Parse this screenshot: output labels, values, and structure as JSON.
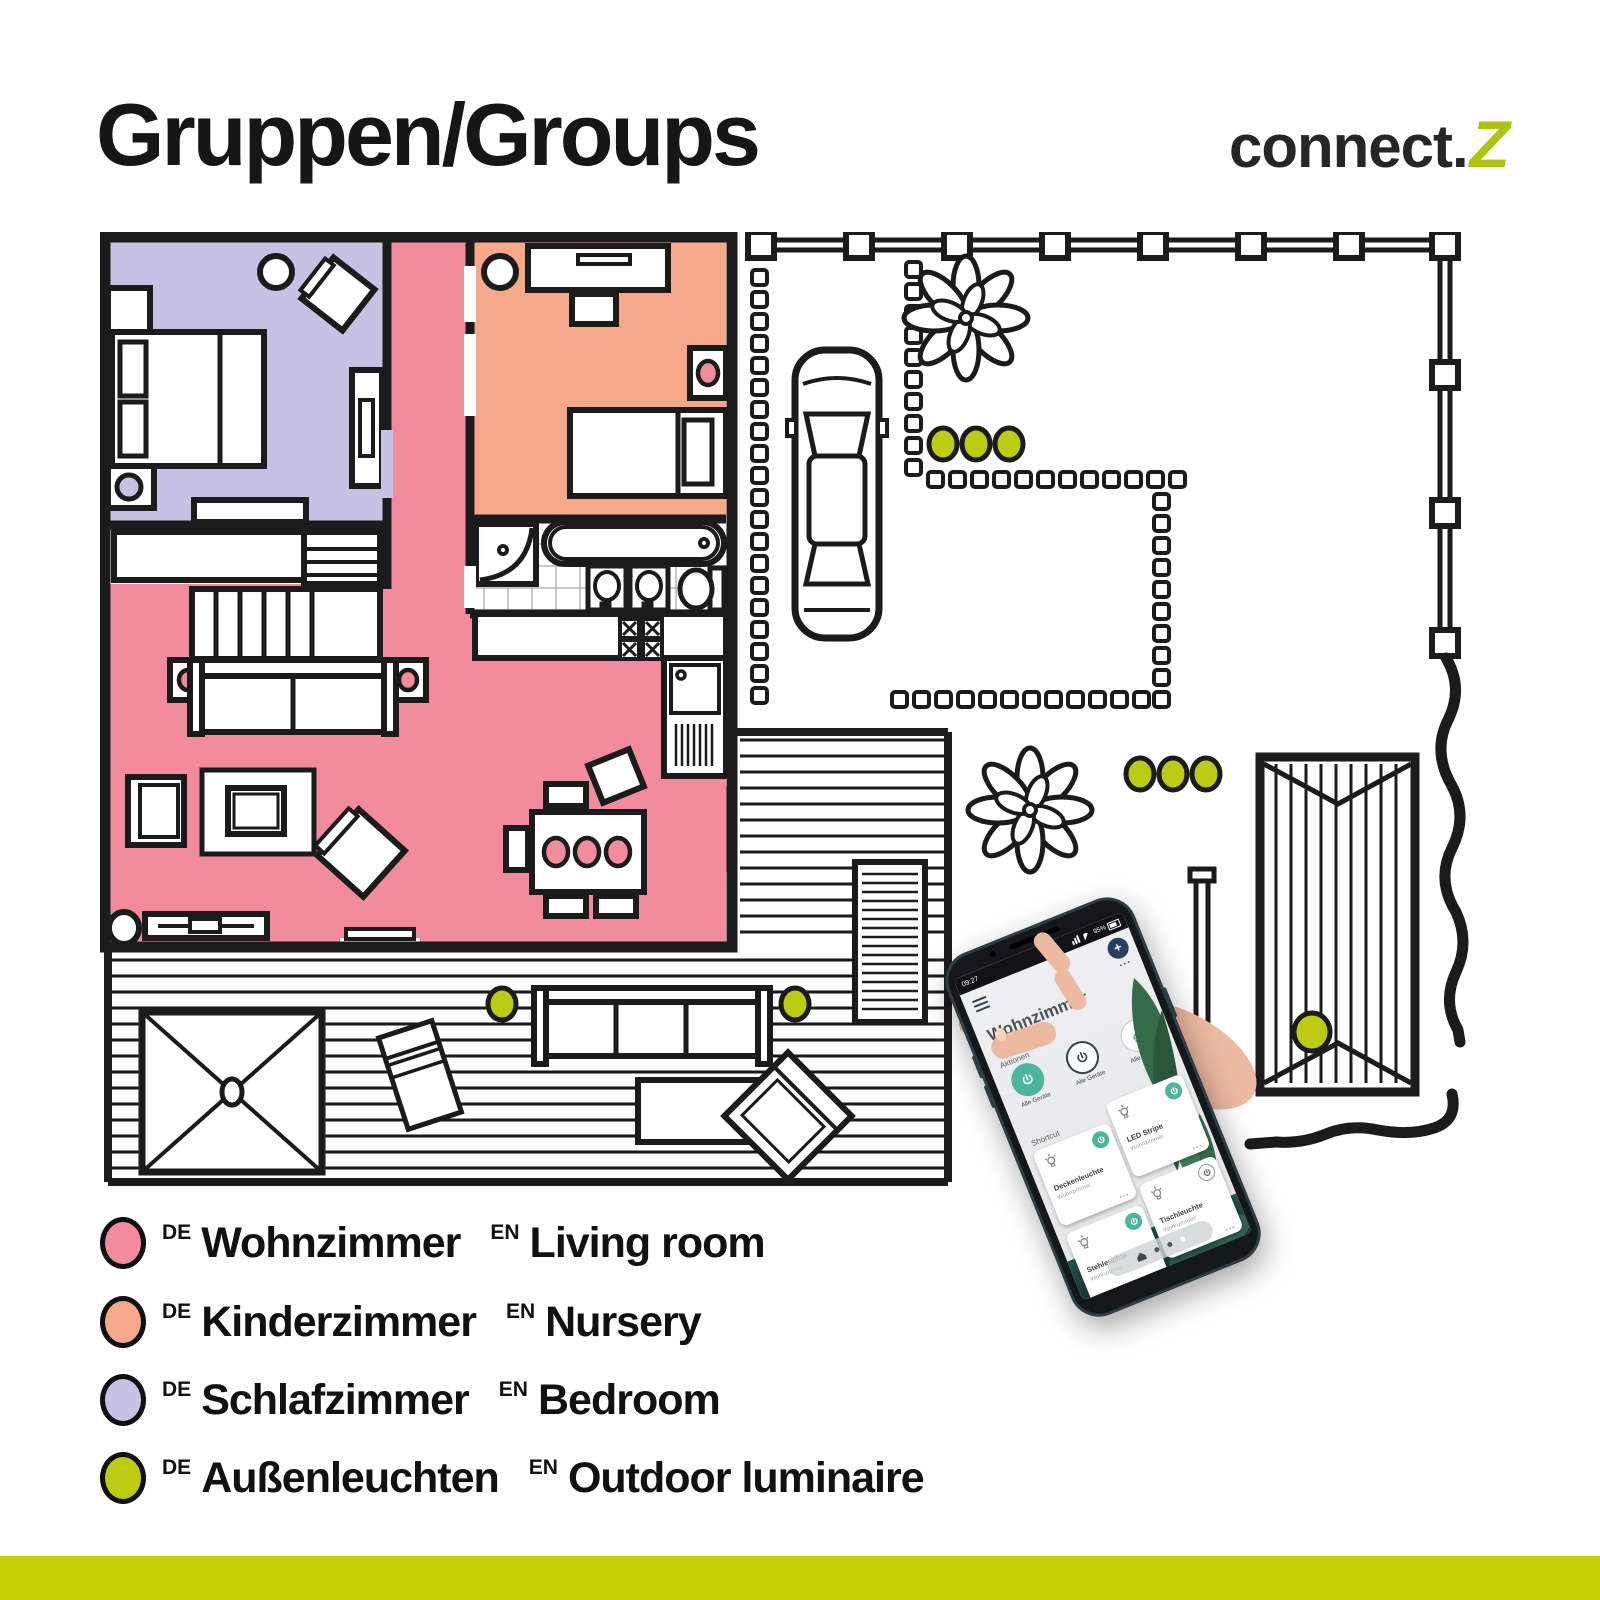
{
  "header": {
    "title": "Gruppen/Groups"
  },
  "brand": {
    "name": "connect.",
    "z": "Z"
  },
  "colors": {
    "living_room": "#F28C9D",
    "nursery": "#F5A98A",
    "bedroom": "#C7C1E4",
    "outdoor": "#BCCC12",
    "bottom_bar": "#C3CF02",
    "brand_z": "#AFC20F",
    "app_accent": "#4CB59C"
  },
  "legend": {
    "items": [
      {
        "de_tag": "DE",
        "de": "Wohnzimmer",
        "en_tag": "EN",
        "en": "Living room",
        "color": "#F28C9D"
      },
      {
        "de_tag": "DE",
        "de": "Kinderzimmer",
        "en_tag": "EN",
        "en": "Nursery",
        "color": "#F5A98A"
      },
      {
        "de_tag": "DE",
        "de": "Schlafzimmer",
        "en_tag": "EN",
        "en": "Bedroom",
        "color": "#C7C1E4"
      },
      {
        "de_tag": "DE",
        "de": "Außenleuchten",
        "en_tag": "EN",
        "en": "Outdoor luminaire",
        "color": "#BCCC12"
      }
    ]
  },
  "floor_plan": {
    "rooms": [
      {
        "name": "Wohnzimmer",
        "color": "#F28C9D"
      },
      {
        "name": "Kinderzimmer",
        "color": "#F5A98A"
      },
      {
        "name": "Schlafzimmer",
        "color": "#C7C1E4"
      }
    ],
    "outdoor_light_count": 9
  },
  "phone": {
    "status_bar": {
      "time": "09:27",
      "battery": "95%"
    },
    "app": {
      "title": "Wohnzimmer",
      "add_icon": "+",
      "more_icon": "...",
      "actions_label": "Aktionen",
      "shortcut_label": "Shortcut",
      "actions": [
        {
          "label": "Alle Geräte",
          "state": "on"
        },
        {
          "label": "Alle Geräte",
          "state": "off"
        },
        {
          "label": "Alle Geräte",
          "state": "off"
        }
      ],
      "tiles": [
        {
          "name": "Deckenleuchte",
          "room": "Wohnzimmer",
          "power": "on",
          "more": "..."
        },
        {
          "name": "LED Stripe",
          "room": "Wohnzimmer",
          "power": "on",
          "more": "..."
        },
        {
          "name": "Stehleuchte",
          "room": "Wohnzimmer",
          "power": "on",
          "more": "..."
        },
        {
          "name": "Tischleuchte",
          "room": "Wohnzimmer",
          "power": "off",
          "more": "..."
        }
      ]
    }
  }
}
